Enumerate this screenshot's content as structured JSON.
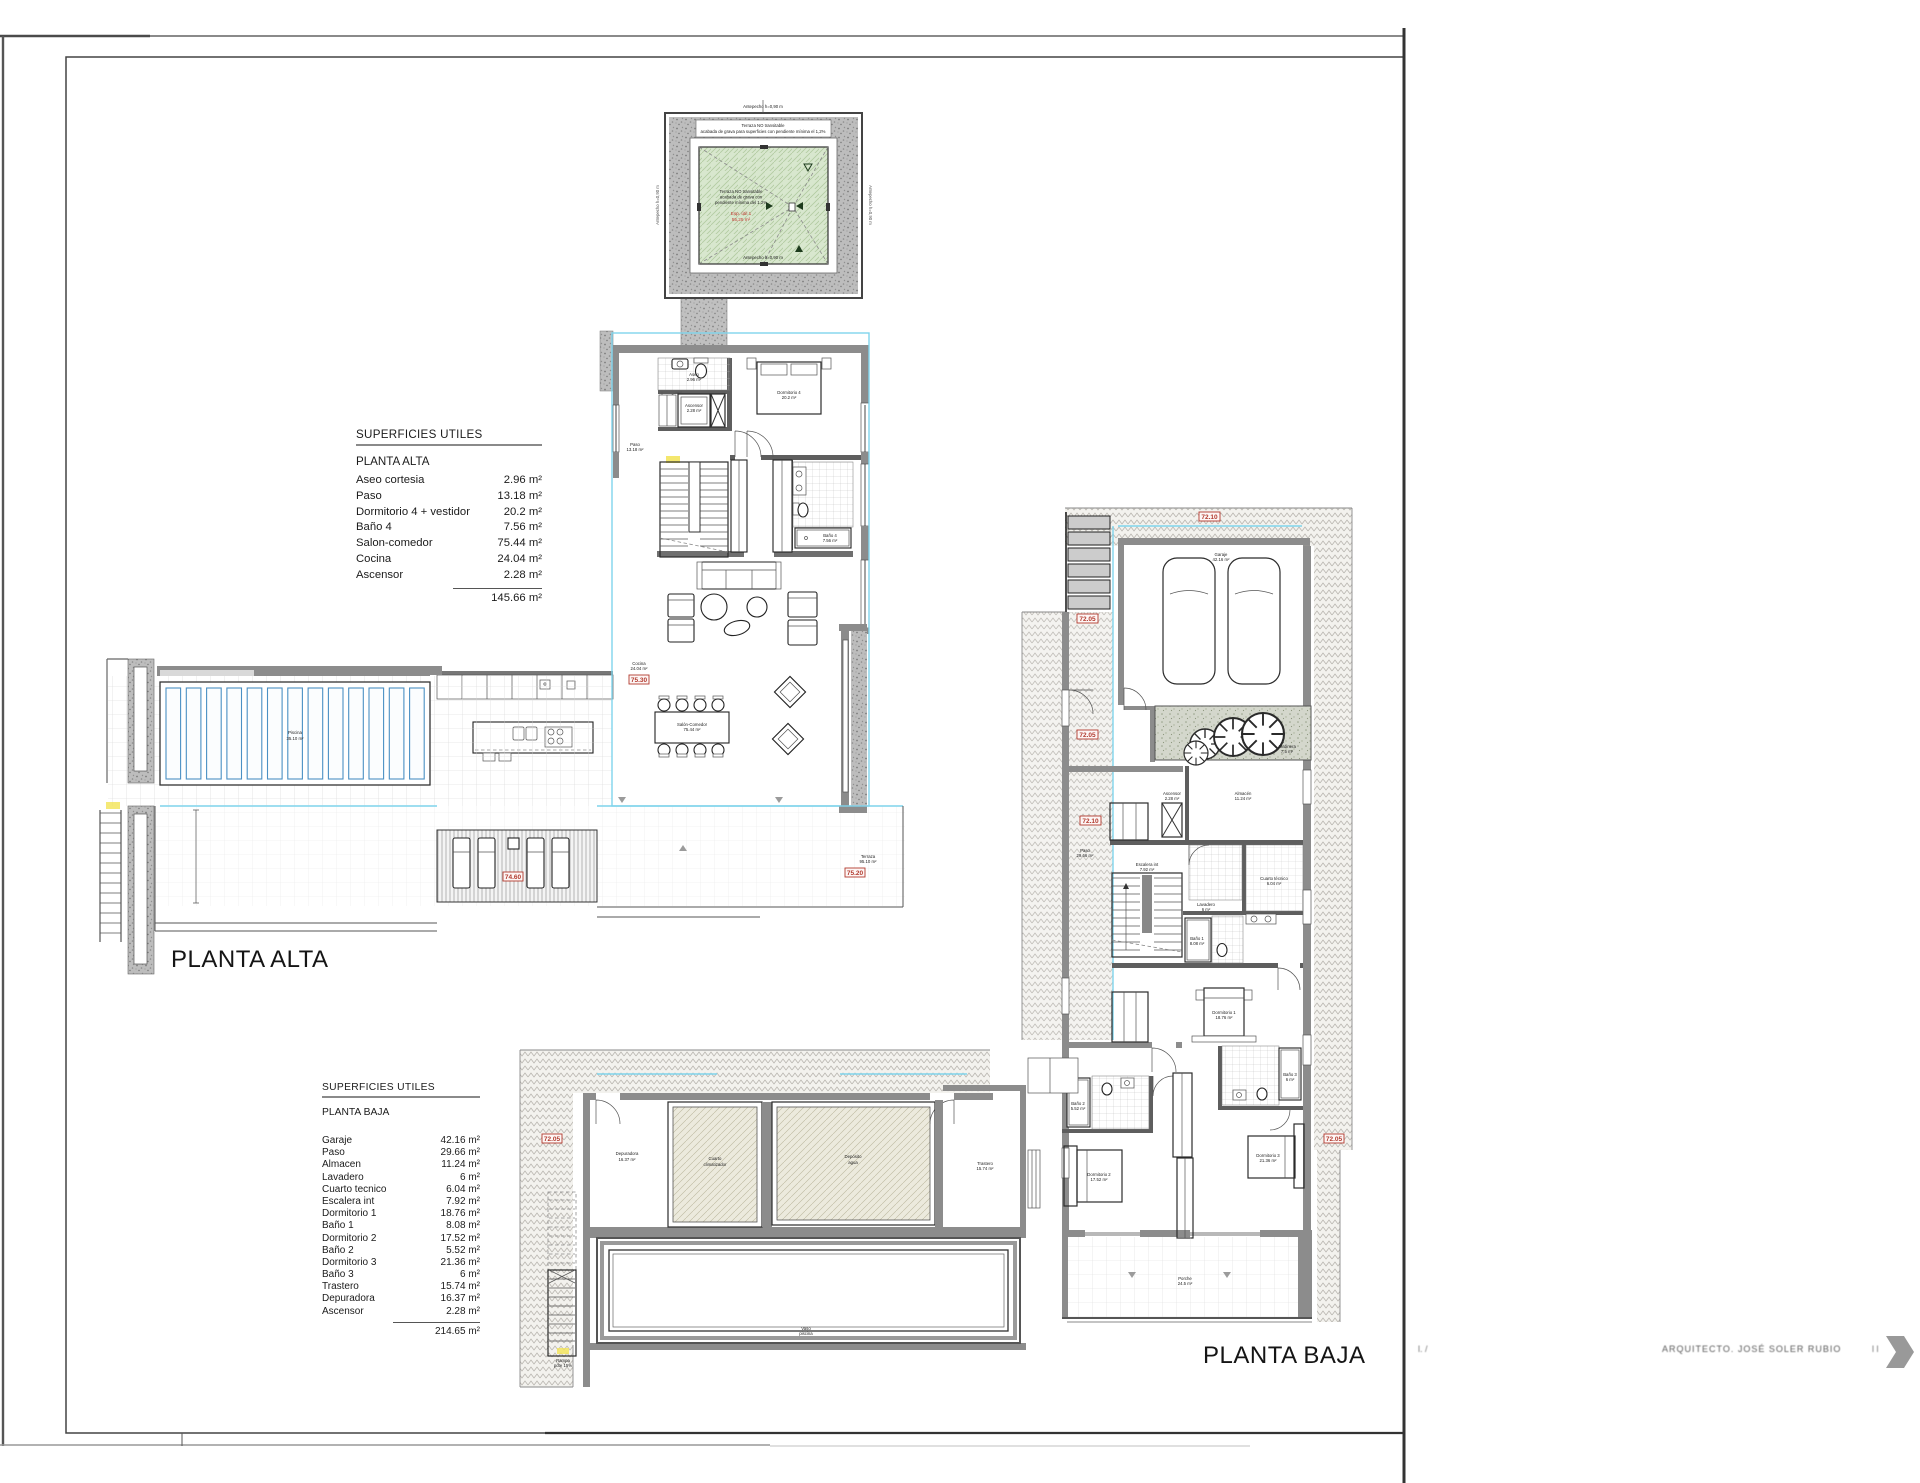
{
  "page": {
    "planta_alta_title": "PLANTA ALTA",
    "planta_baja_title": "PLANTA BAJA",
    "footer": {
      "frag_left": "l.  /",
      "architect": "ARQUITECTO.  JOSÉ SOLER RUBIO",
      "frag_right": "l  l"
    }
  },
  "colors": {
    "tag_red": "#b23a2e",
    "overlay_cyan": "#7fd4ec",
    "pool_blue": "#4a90c4",
    "roof_green": "#d8e7ce",
    "wall_gray": "#8c8c8c"
  },
  "tables": {
    "alta": {
      "header": "SUPERFICIES UTILES",
      "floor": "PLANTA ALTA",
      "rows": [
        {
          "l": "Aseo cortesia",
          "v": "2.96 m²"
        },
        {
          "l": "Paso",
          "v": "13.18 m²"
        },
        {
          "l": "Dormitorio 4 + vestidor",
          "v": "20.2 m²"
        },
        {
          "l": "Baño 4",
          "v": "7.56 m²"
        },
        {
          "l": "Salon-comedor",
          "v": "75.44 m²"
        },
        {
          "l": "Cocina",
          "v": "24.04 m²"
        },
        {
          "l": "Ascensor",
          "v": "2.28 m²"
        }
      ],
      "total": "145.66 m²"
    },
    "baja": {
      "header": "SUPERFICIES UTILES",
      "floor": "PLANTA BAJA",
      "rows": [
        {
          "l": "Garaje",
          "v": "42.16 m²"
        },
        {
          "l": "Paso",
          "v": "29.66 m²"
        },
        {
          "l": "Almacen",
          "v": "11.24 m²"
        },
        {
          "l": "Lavadero",
          "v": "6 m²"
        },
        {
          "l": "Cuarto tecnico",
          "v": "6.04 m²"
        },
        {
          "l": "Escalera int",
          "v": "7.92 m²"
        },
        {
          "l": "Dormitorio 1",
          "v": "18.76 m²"
        },
        {
          "l": "Baño 1",
          "v": "8.08 m²"
        },
        {
          "l": "Dormitorio 2",
          "v": "17.52 m²"
        },
        {
          "l": "Baño 2",
          "v": "5.52 m²"
        },
        {
          "l": "Dormitorio 3",
          "v": "21.36 m²"
        },
        {
          "l": "Baño 3",
          "v": "6 m²"
        },
        {
          "l": "Trastero",
          "v": "15.74 m²"
        },
        {
          "l": "Depuradora",
          "v": "16.37 m²"
        },
        {
          "l": "Ascensor",
          "v": "2.28 m²"
        }
      ],
      "total": "214.65 m²"
    }
  },
  "roof": {
    "banner1": "Terraza NO transitable",
    "banner2": "acabada de grava para superficies con pendiente mínima el 1,2%",
    "note1": "Terraza NO transitable",
    "note2": "acabada de grava con",
    "note3": "pendiente mínima del 1,2%",
    "red1": "Esp. útil 1",
    "red2": "55,25 m²",
    "parapet_top": "Antepecho h=0,90 m",
    "parapet_bottom": "Antepecho h=0,90 m"
  },
  "tags": {
    "a_int": "75.30",
    "a_deck": "74.60",
    "a_terr": "75.20",
    "b_top": "72.10",
    "b_drive1": "72.05",
    "b_drive2": "72.05",
    "b_int": "72.10",
    "b_right": "72.05",
    "b_wing": "72.05"
  },
  "micro": {
    "a_piscina": [
      "Piscina",
      "35.10 m²"
    ],
    "a_terraza": [
      "Terraza",
      "95.10 m²"
    ],
    "a_salon": [
      "Salón-Comedor",
      "75.44 m²"
    ],
    "a_cocina": [
      "Cocina",
      "24.04 m²"
    ],
    "a_dorm4": [
      "Dormitorio 4",
      "20.2 m²"
    ],
    "a_bano4": [
      "Baño 4",
      "7.56 m²"
    ],
    "a_asc": [
      "Ascensor",
      "2.28 m²"
    ],
    "a_aseo": [
      "Aseo",
      "2.96 m²"
    ],
    "a_paso": [
      "Paso",
      "13.18 m²"
    ],
    "b_garaje": [
      "Garaje",
      "42.16 m²"
    ],
    "b_jardinera": [
      "Jardinera",
      "7,5 m²"
    ],
    "b_almacen": [
      "Almacén",
      "11.24 m²"
    ],
    "b_ascensor": [
      "Ascensor",
      "2.28 m²"
    ],
    "b_ctec": [
      "Cuarto técnico",
      "6.04 m²"
    ],
    "b_escalera": [
      "Escalera int",
      "7.92 m²"
    ],
    "b_lavadero": [
      "Lavadero",
      "6 m²"
    ],
    "b_bano1": [
      "Baño 1",
      "8.08 m²"
    ],
    "b_dorm1": [
      "Dormitorio 1",
      "18.76 m²"
    ],
    "b_bano2": [
      "Baño 2",
      "5.52 m²"
    ],
    "b_dorm2": [
      "Dormitorio 2",
      "17.52 m²"
    ],
    "b_bano3": [
      "Baño 3",
      "6 m²"
    ],
    "b_dorm3": [
      "Dormitorio 3",
      "21.36 m²"
    ],
    "b_paso": [
      "Paso",
      "29.66 m²"
    ],
    "b_porche": [
      "Porche",
      "24.5 m²"
    ],
    "b_trastero": [
      "Trastero",
      "15.74 m²"
    ],
    "b_depuradora": [
      "Depuradora",
      "16.37 m²"
    ],
    "b_clim": [
      "Cuarto",
      "climatizador"
    ],
    "b_deposito": [
      "Depósito",
      "agua"
    ],
    "b_vaso": [
      "Vaso",
      "piscina"
    ],
    "b_rampa": [
      "Rampa",
      "pdte 15%"
    ]
  }
}
